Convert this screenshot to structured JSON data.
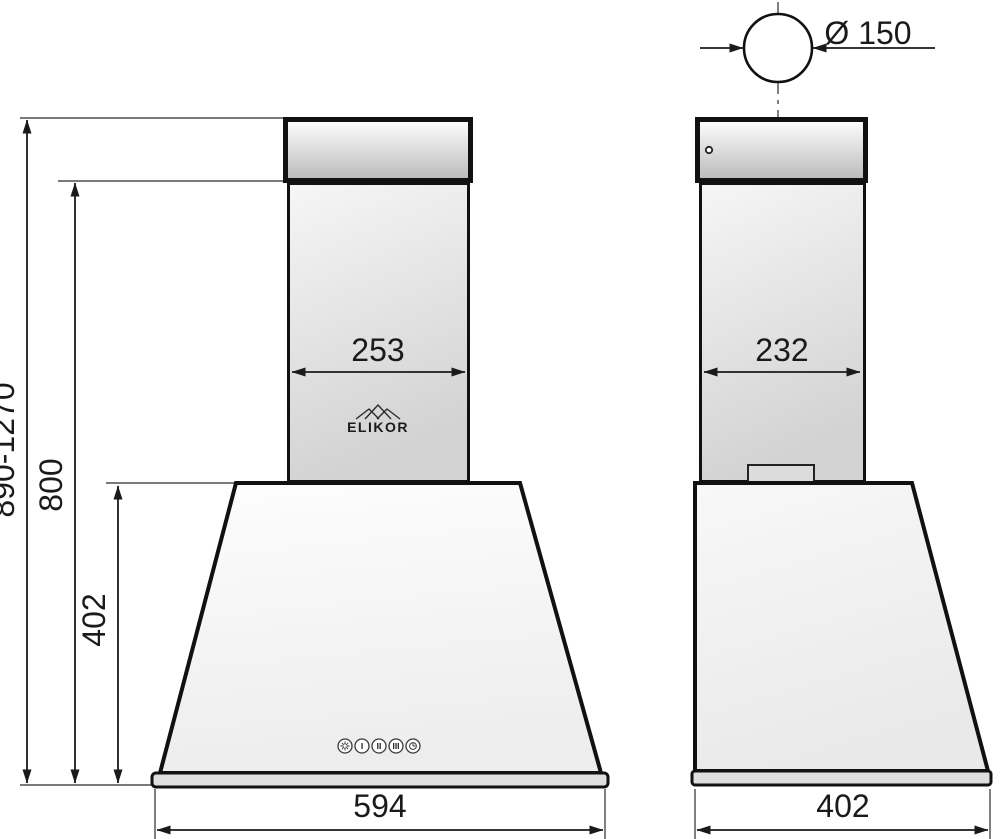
{
  "page": {
    "description": "Dimensional technical drawing of a wall-mounted kitchen range hood, front view and side view",
    "background": "#ffffff"
  },
  "brand": {
    "logo_text": "ELIKOR",
    "logo_icon": "roof-peaks-icon"
  },
  "front_view": {
    "dim_overall_height": "890-1270",
    "dim_height_to_duct": "800",
    "dim_body_height": "402",
    "dim_chimney_width": "253",
    "dim_body_width": "594"
  },
  "side_view": {
    "dim_duct_diameter": "Ø 150",
    "dim_chimney_depth": "232",
    "dim_body_depth": "402"
  },
  "controls": {
    "button_icons": [
      "light-icon",
      "speed-1",
      "speed-2",
      "speed-3",
      "timer-icon"
    ],
    "speed1_label": "I",
    "speed2_label": "II",
    "speed3_label": "III"
  },
  "colors": {
    "line": "#1a1a1a",
    "cap_fill_top": "#ffffff",
    "cap_fill_bottom": "#b9b9b9",
    "chimney_fill_top": "#f5f5f5",
    "chimney_fill_bottom": "#d2d2d2",
    "body_fill_top": "#fdfdfd",
    "body_fill_bottom": "#eeeeee",
    "baseplate_fill": "#dedede"
  }
}
